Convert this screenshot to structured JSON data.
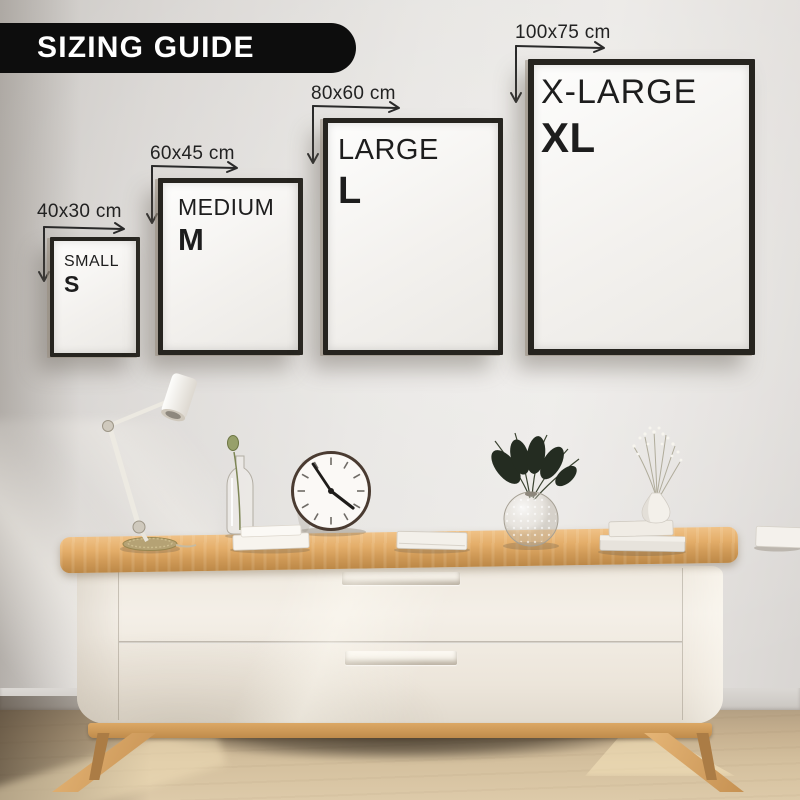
{
  "banner": {
    "title": "SIZING GUIDE"
  },
  "frames": [
    {
      "size_label": "40x30 cm",
      "name": "SMALL",
      "abbr": "S"
    },
    {
      "size_label": "60x45 cm",
      "name": "MEDIUM",
      "abbr": "M"
    },
    {
      "size_label": "80x60 cm",
      "name": "LARGE",
      "abbr": "L"
    },
    {
      "size_label": "100x75 cm",
      "name": "X-LARGE",
      "abbr": "XL"
    }
  ],
  "colors": {
    "banner_bg": "#0d0d0d",
    "banner_text": "#ffffff",
    "frame_border": "#26241f",
    "frame_text": "#1d1d1d",
    "wall": "#e5e3e0",
    "wood": "#d9a55f",
    "cabinet_body": "#f1ece3",
    "floor": "#cdb795"
  }
}
